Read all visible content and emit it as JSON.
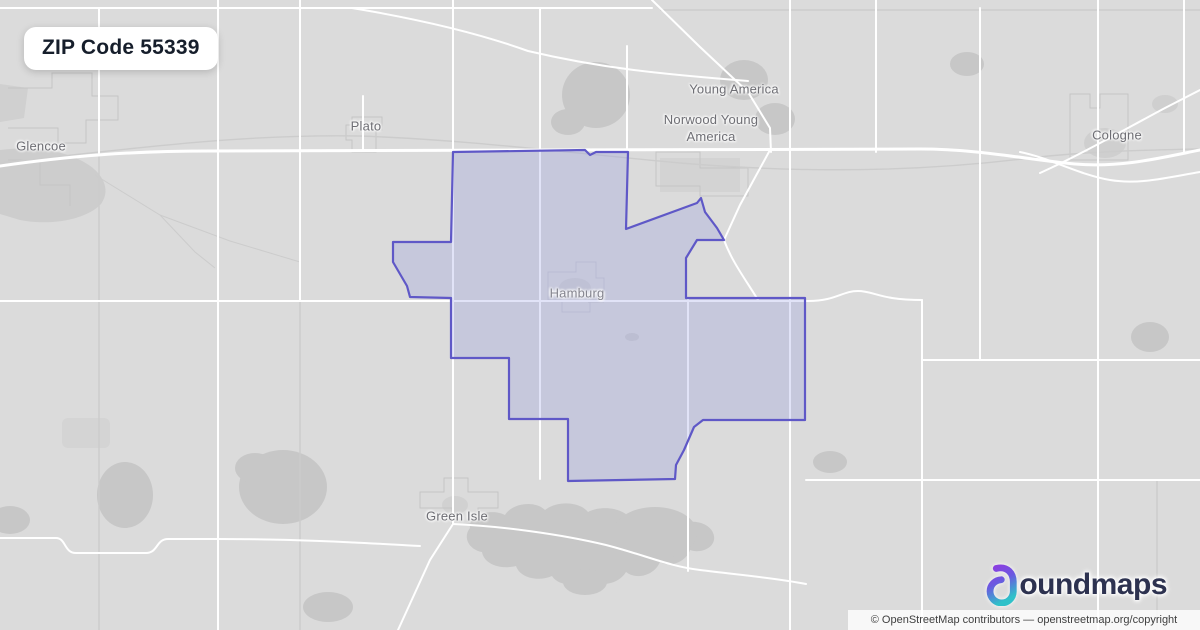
{
  "badge": {
    "title": "ZIP Code 55339"
  },
  "map": {
    "labels": [
      {
        "id": "glencoe",
        "name": "Glencoe"
      },
      {
        "id": "plato",
        "name": "Plato"
      },
      {
        "id": "young-america",
        "name": "Young America"
      },
      {
        "id": "norwood-young-america",
        "name": "Norwood Young America"
      },
      {
        "id": "cologne",
        "name": "Cologne"
      },
      {
        "id": "hamburg",
        "name": "Hamburg"
      },
      {
        "id": "green-isle",
        "name": "Green Isle"
      }
    ],
    "highlighted_zip": "55339"
  },
  "logo": {
    "name": "boundmaps",
    "wordmark": "oundmaps"
  },
  "attribution": {
    "text": "© OpenStreetMap contributors — openstreetmap.org/copyright"
  },
  "colors": {
    "map_background": "#dbdbdb",
    "road": "#ffffff",
    "minor_road": "#cccccc",
    "water_forest": "#c7c7c7",
    "zip_fill": "rgba(140,145,225,0.26)",
    "zip_stroke": "#5f58c7",
    "label_text": "#6e6e74",
    "badge_text": "#161e2b",
    "brand_navy": "#2d3250",
    "brand_purple": "#8b3fe0",
    "brand_teal": "#2fc1c9"
  }
}
